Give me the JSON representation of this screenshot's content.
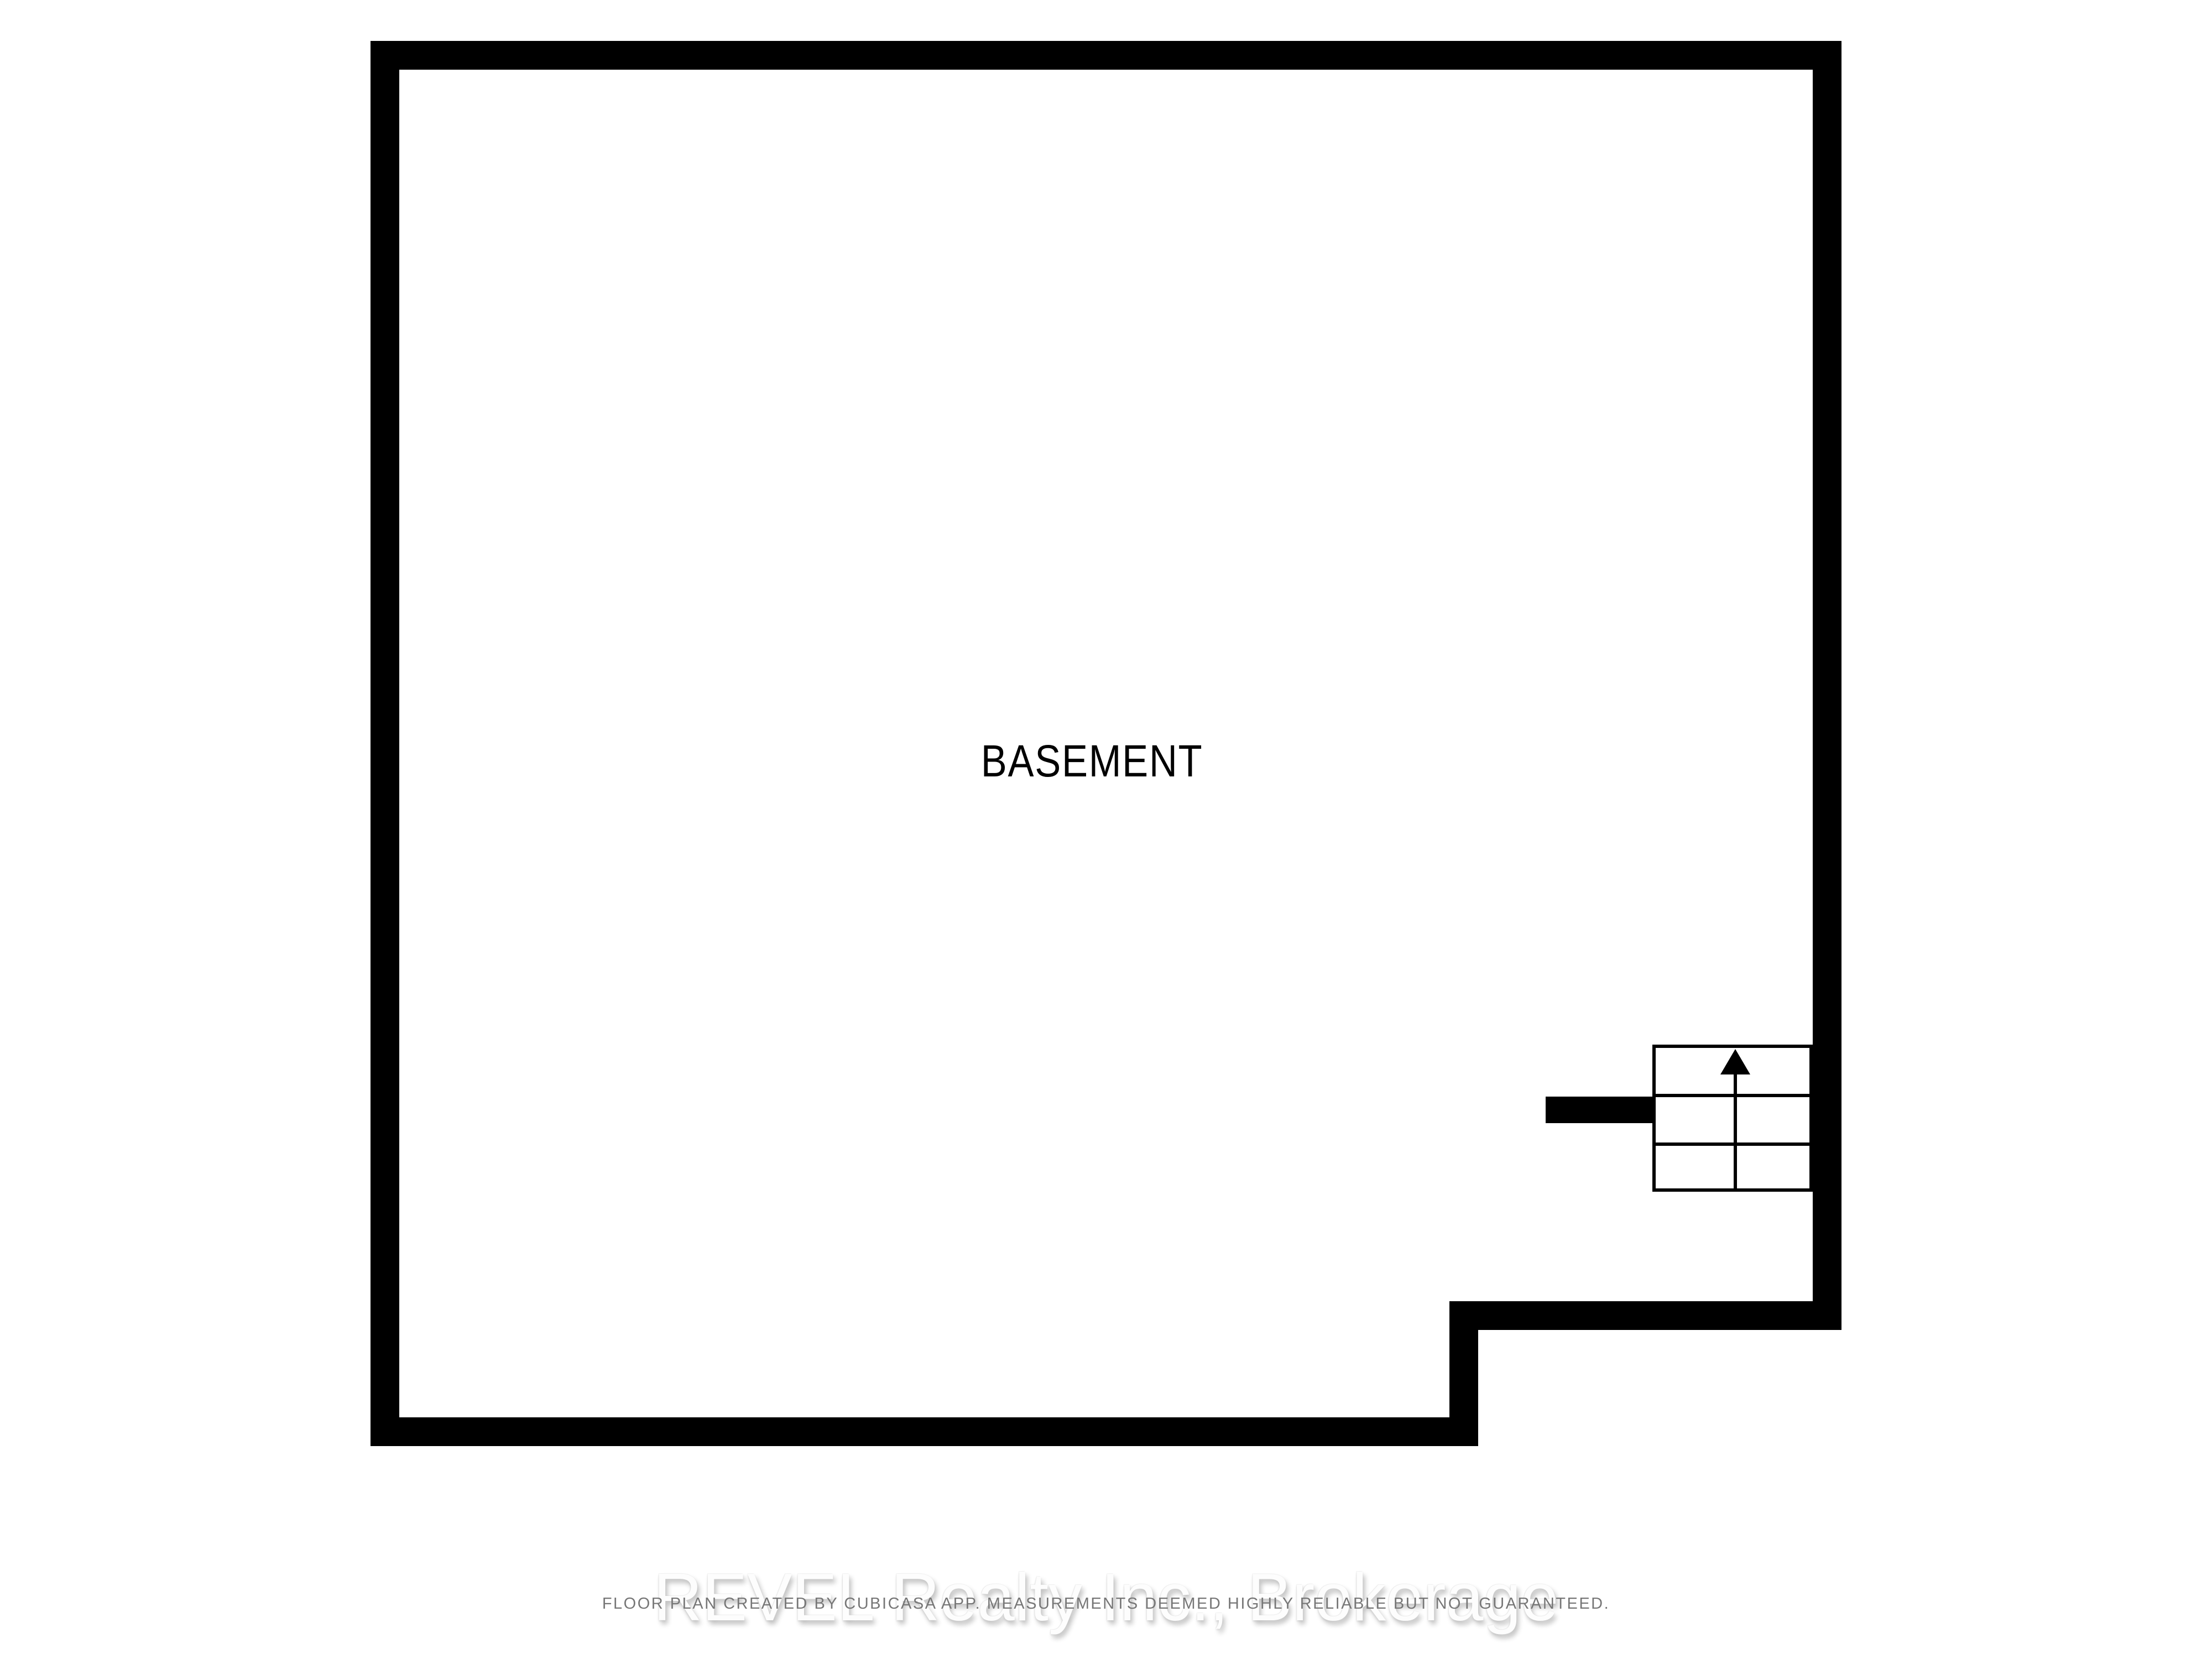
{
  "plan": {
    "room_label": "BASEMENT",
    "stairs": {
      "icon": "stairs-up-arrow-icon",
      "direction": "up",
      "columns": 2,
      "rows": 3
    }
  },
  "footer": {
    "watermark": "REVEL Realty Inc., Brokerage",
    "disclaimer": "FLOOR PLAN CREATED BY CUBICASA APP. MEASUREMENTS DEEMED HIGHLY RELIABLE BUT NOT GUARANTEED."
  },
  "colors": {
    "background": "#ffffff",
    "wall": "#000000",
    "room_label_text": "#000000",
    "disclaimer_text": "#767676",
    "watermark_text": "#fdfdfd",
    "watermark_shadow": "#c0c0c0"
  }
}
